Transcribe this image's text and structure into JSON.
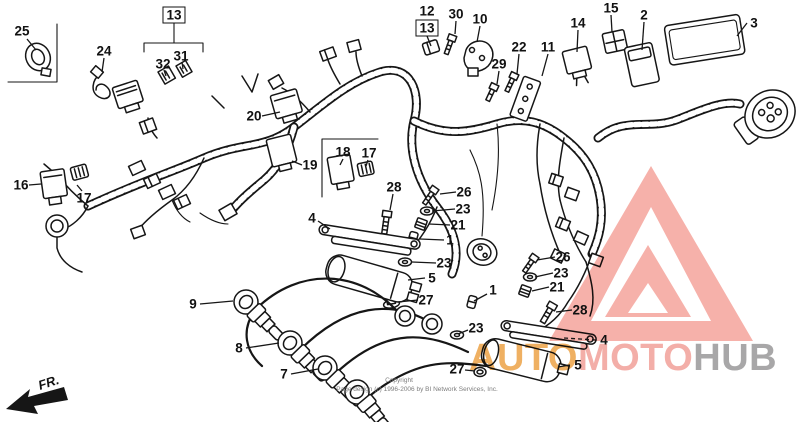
{
  "diagram": {
    "kind": "wire-harness parts diagram"
  },
  "fr": {
    "label": "FR."
  },
  "copyright": {
    "line1": "Copyright",
    "line2": "Page design (c) 1996-2006 by BI Network Services, Inc."
  },
  "watermark": {
    "triangle_color": "#f5a9a1",
    "segments": [
      {
        "text": "AUTO",
        "color": "#eda64d"
      },
      {
        "text": "MOTO",
        "color": "#f2a39c"
      },
      {
        "text": "HUB",
        "color": "#9c9b9c"
      }
    ]
  },
  "colors": {
    "line": "#161616",
    "background": "#ffffff"
  },
  "callouts": [
    {
      "text": "25",
      "x": 22,
      "y": 31,
      "lead": [
        27,
        39,
        36,
        50
      ]
    },
    {
      "text": "24",
      "x": 104,
      "y": 51,
      "lead": [
        104,
        58,
        102,
        72
      ]
    },
    {
      "text": "13",
      "x": 174,
      "y": 15,
      "boxed": true
    },
    {
      "text": "32",
      "x": 163,
      "y": 64,
      "lead": [
        164,
        70,
        166,
        76
      ]
    },
    {
      "text": "31",
      "x": 181,
      "y": 56,
      "lead": [
        182,
        62,
        183,
        69
      ]
    },
    {
      "text": "20",
      "x": 254,
      "y": 116,
      "lead": [
        262,
        116,
        280,
        112
      ]
    },
    {
      "text": "12",
      "x": 427,
      "y": 11
    },
    {
      "text": "13",
      "x": 427,
      "y": 28,
      "boxed": true,
      "lead": [
        427,
        36,
        431,
        46
      ]
    },
    {
      "text": "30",
      "x": 456,
      "y": 14,
      "lead": [
        456,
        21,
        455,
        34
      ]
    },
    {
      "text": "10",
      "x": 480,
      "y": 19,
      "lead": [
        480,
        26,
        477,
        42
      ]
    },
    {
      "text": "22",
      "x": 519,
      "y": 47,
      "lead": [
        519,
        54,
        517,
        74
      ]
    },
    {
      "text": "29",
      "x": 499,
      "y": 64,
      "lead": [
        499,
        71,
        497,
        84
      ]
    },
    {
      "text": "11",
      "x": 548,
      "y": 47,
      "lead": [
        548,
        54,
        542,
        76
      ]
    },
    {
      "text": "14",
      "x": 578,
      "y": 23,
      "lead": [
        578,
        30,
        577,
        52
      ]
    },
    {
      "text": "15",
      "x": 611,
      "y": 8,
      "lead": [
        611,
        15,
        612,
        32
      ]
    },
    {
      "text": "2",
      "x": 644,
      "y": 15,
      "lead": [
        644,
        22,
        642,
        50
      ]
    },
    {
      "text": "3",
      "x": 754,
      "y": 23,
      "lead": [
        747,
        23,
        737,
        36
      ]
    },
    {
      "text": "16",
      "x": 21,
      "y": 185,
      "lead": [
        29,
        185,
        41,
        184
      ]
    },
    {
      "text": "17",
      "x": 84,
      "y": 198,
      "lead": [
        82,
        191,
        77,
        185
      ]
    },
    {
      "text": "19",
      "x": 310,
      "y": 165,
      "lead": [
        302,
        165,
        292,
        161
      ]
    },
    {
      "text": "18",
      "x": 343,
      "y": 152,
      "lead": [
        343,
        159,
        340,
        165
      ]
    },
    {
      "text": "17",
      "x": 369,
      "y": 153,
      "lead": [
        368,
        160,
        366,
        166
      ]
    },
    {
      "text": "28",
      "x": 394,
      "y": 187,
      "lead": [
        393,
        194,
        390,
        210
      ]
    },
    {
      "text": "26",
      "x": 464,
      "y": 192,
      "lead": [
        456,
        192,
        440,
        194
      ]
    },
    {
      "text": "23",
      "x": 463,
      "y": 209,
      "lead": [
        455,
        209,
        432,
        211
      ]
    },
    {
      "text": "21",
      "x": 458,
      "y": 225,
      "lead": [
        450,
        225,
        429,
        224
      ]
    },
    {
      "text": "1",
      "x": 450,
      "y": 240,
      "lead": [
        444,
        240,
        420,
        239
      ]
    },
    {
      "text": "4",
      "x": 312,
      "y": 218,
      "lead": [
        318,
        221,
        330,
        229
      ]
    },
    {
      "text": "23",
      "x": 444,
      "y": 263,
      "lead": [
        436,
        263,
        412,
        262
      ]
    },
    {
      "text": "5",
      "x": 432,
      "y": 278,
      "lead": [
        425,
        278,
        408,
        280
      ]
    },
    {
      "text": "27",
      "x": 426,
      "y": 300,
      "lead": [
        418,
        300,
        398,
        302
      ]
    },
    {
      "text": "9",
      "x": 193,
      "y": 304,
      "lead": [
        200,
        304,
        233,
        301
      ]
    },
    {
      "text": "8",
      "x": 239,
      "y": 348,
      "lead": [
        246,
        348,
        279,
        343
      ]
    },
    {
      "text": "7",
      "x": 284,
      "y": 374,
      "lead": [
        291,
        374,
        318,
        369
      ]
    },
    {
      "text": "26",
      "x": 563,
      "y": 257,
      "lead": [
        555,
        257,
        537,
        260
      ]
    },
    {
      "text": "23",
      "x": 561,
      "y": 273,
      "lead": [
        553,
        273,
        535,
        277
      ]
    },
    {
      "text": "21",
      "x": 557,
      "y": 287,
      "lead": [
        549,
        287,
        532,
        291
      ]
    },
    {
      "text": "28",
      "x": 580,
      "y": 310,
      "lead": [
        572,
        310,
        556,
        312
      ]
    },
    {
      "text": "1",
      "x": 493,
      "y": 290,
      "lead": [
        487,
        294,
        474,
        301
      ]
    },
    {
      "text": "23",
      "x": 476,
      "y": 328,
      "lead": [
        468,
        330,
        458,
        334
      ]
    },
    {
      "text": "4",
      "x": 604,
      "y": 340,
      "lead": [
        596,
        340,
        564,
        338
      ],
      "dash": true
    },
    {
      "text": "5",
      "x": 578,
      "y": 365,
      "lead": [
        570,
        365,
        558,
        367
      ]
    },
    {
      "text": "27",
      "x": 457,
      "y": 369,
      "lead": [
        465,
        370,
        475,
        371
      ]
    }
  ]
}
